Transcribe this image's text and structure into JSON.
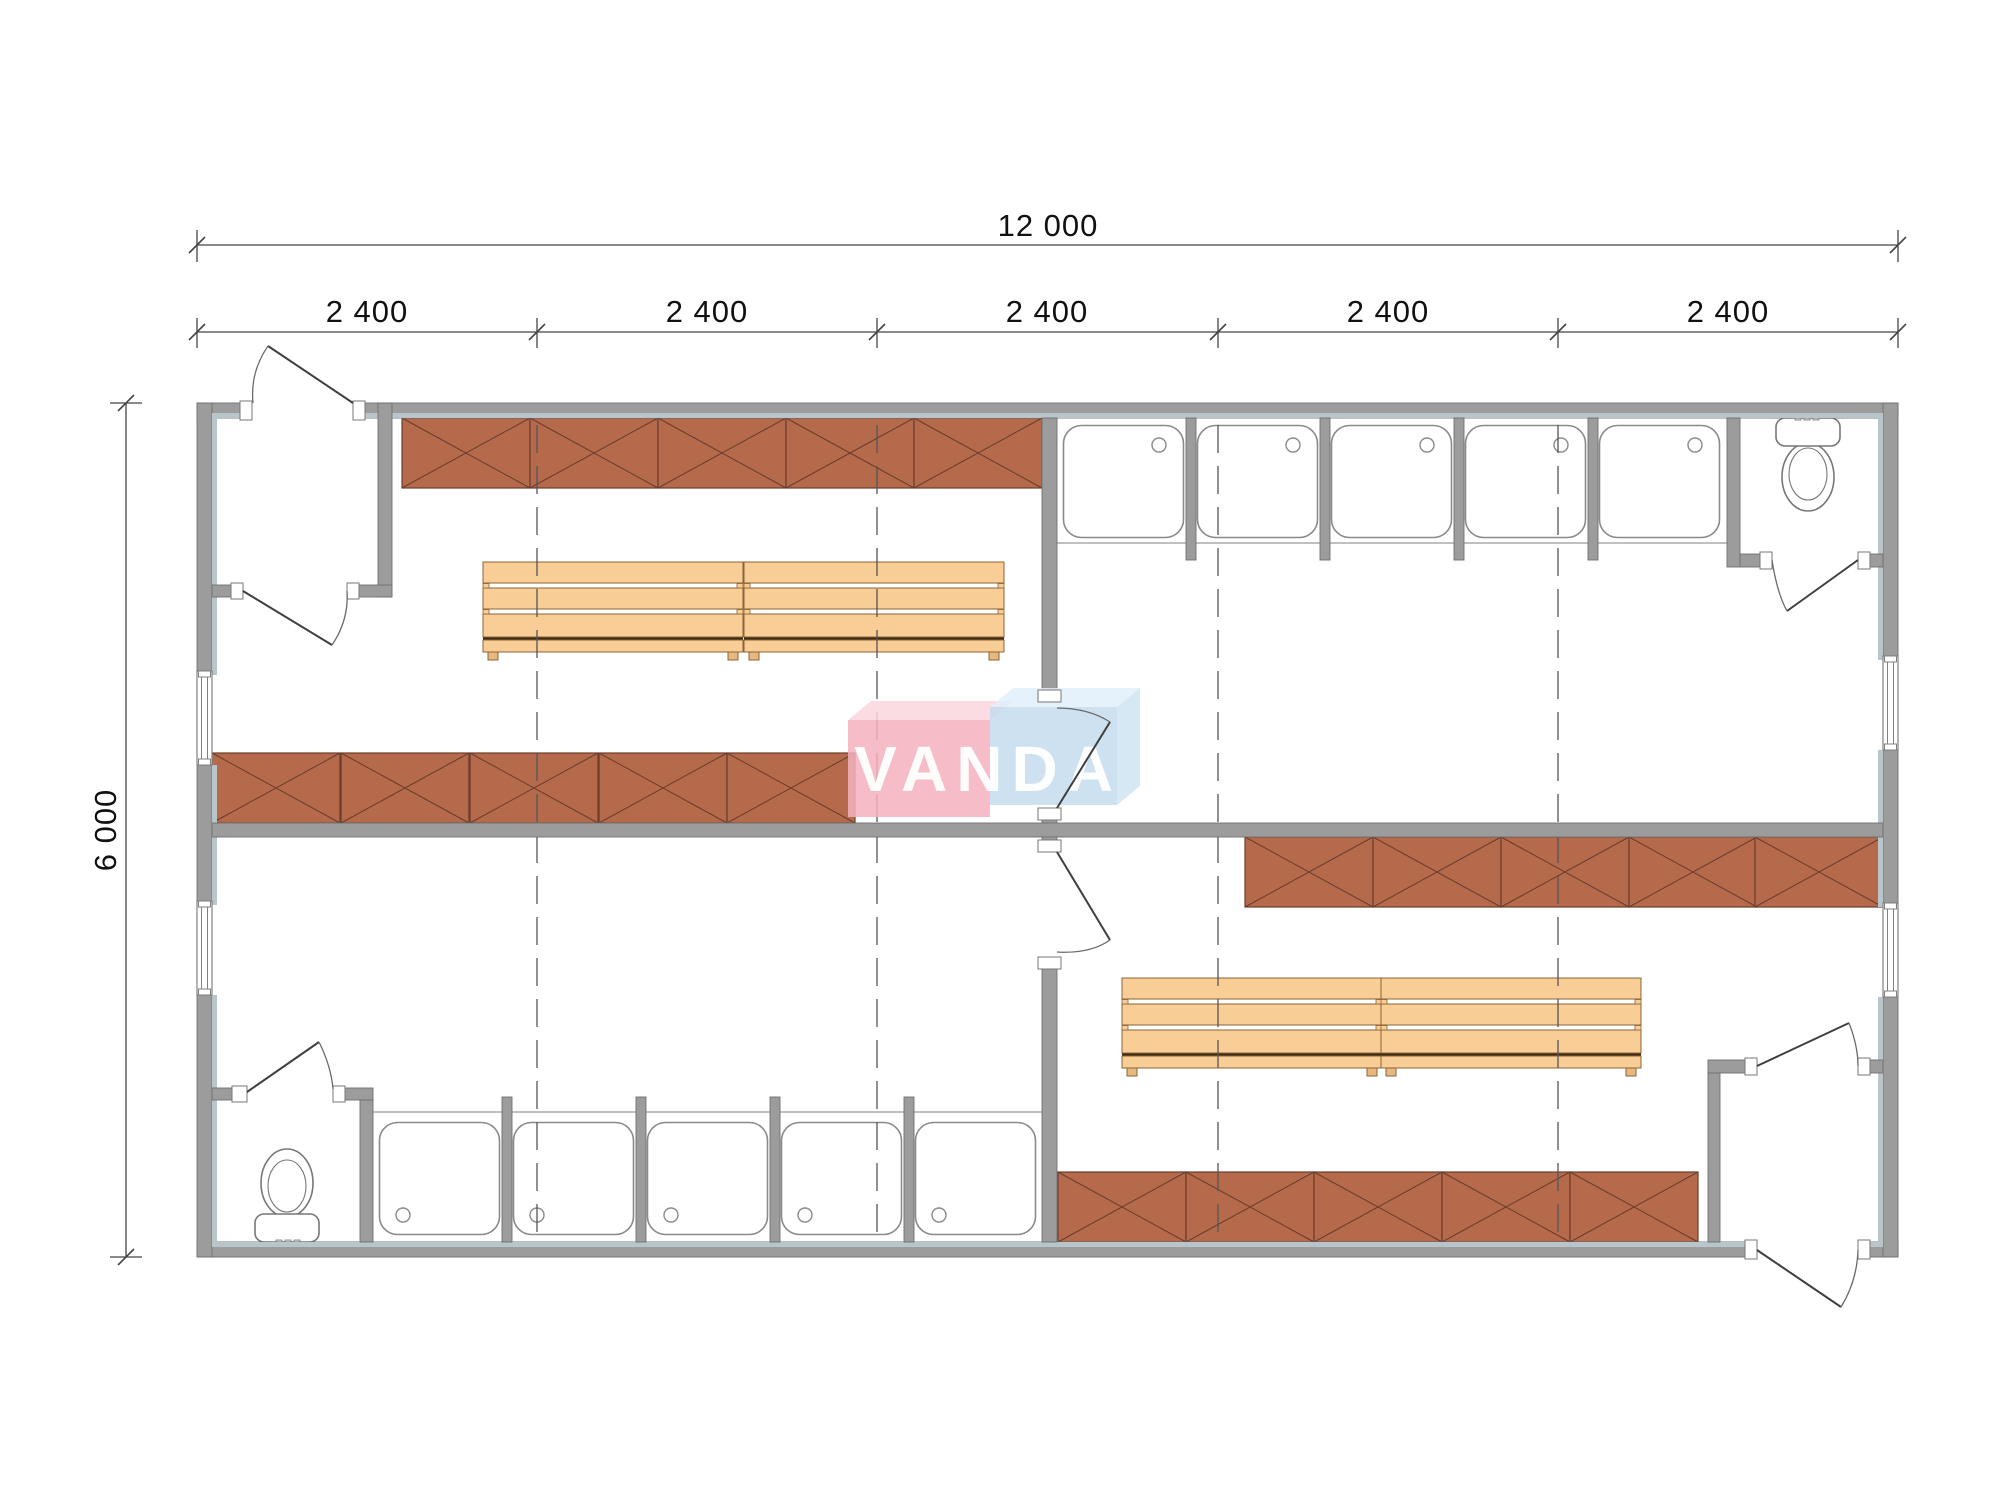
{
  "dimensions": {
    "total_width": "12 000",
    "modules": [
      "2 400",
      "2 400",
      "2 400",
      "2 400",
      "2 400"
    ],
    "total_height": "6 000"
  },
  "watermark": {
    "text": "VANDA",
    "pink": "#f4b2c0",
    "blue": "#c3daee"
  },
  "colors": {
    "wall": "#9c9c9c",
    "wall_liner": "#b8c5cb",
    "locker": "#b56a4c",
    "locker_line": "#6b3c2a",
    "bench": "#f8cd96",
    "bench_line": "#8a6436",
    "drawing_line": "#444444"
  },
  "fixtures": {
    "locker_rows": 4,
    "locker_cells_per_row": 5,
    "bench_units": 4,
    "shower_stalls": 10,
    "toilets": 2,
    "windows": 4,
    "exterior_doors": 2,
    "interior_doors": 6
  }
}
